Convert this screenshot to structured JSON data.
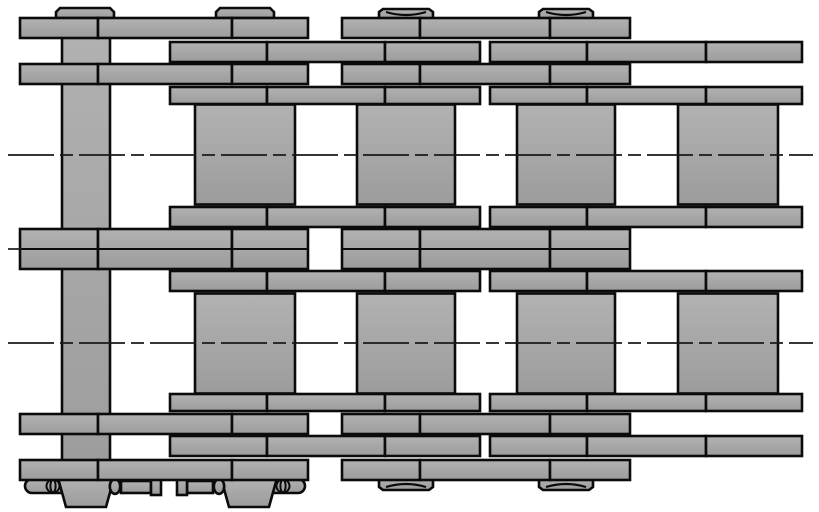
{
  "drawing": {
    "label": "Duplex roller chain plan-view engineering drawing with cottered connecting pins",
    "canvas": {
      "w": 819,
      "h": 512,
      "bg": "#ffffff"
    },
    "style": {
      "fill_top": "#b2b2b2",
      "fill_bottom": "#9c9c9c",
      "outline": "#0b0b0b",
      "outline_w": 2.6,
      "arc_w": 2.2,
      "centerline_color": "#1a1a1a",
      "centerline_w": 1.7,
      "centerline_dash": "46 6 13 6"
    },
    "segments": {
      "pin_phase": [
        [
          20,
          98
        ],
        [
          98,
          232
        ],
        [
          232,
          308
        ],
        [
          342,
          420
        ],
        [
          420,
          550
        ],
        [
          550,
          630
        ]
      ],
      "roller_phase": [
        [
          170,
          267
        ],
        [
          267,
          385
        ],
        [
          385,
          480
        ],
        [
          490,
          587
        ],
        [
          587,
          706
        ],
        [
          706,
          802
        ]
      ]
    },
    "plate_rows": [
      {
        "name": "plate-row-top-outer",
        "phase": "pin_phase",
        "y": 18,
        "h": 20
      },
      {
        "name": "plate-row-top-2",
        "phase": "roller_phase",
        "y": 42,
        "h": 20
      },
      {
        "name": "plate-row-top-3",
        "phase": "pin_phase",
        "y": 64,
        "h": 20
      },
      {
        "name": "plate-row-top-inner",
        "phase": "roller_phase",
        "y": 87,
        "h": 17
      },
      {
        "name": "plate-row-mid-upper",
        "phase": "roller_phase",
        "y": 207,
        "h": 20
      },
      {
        "name": "plate-row-mid-lower",
        "phase": "roller_phase",
        "y": 271,
        "h": 20
      },
      {
        "name": "plate-row-bottom-inner",
        "phase": "roller_phase",
        "y": 394,
        "h": 17
      },
      {
        "name": "plate-row-bottom-3",
        "phase": "pin_phase",
        "y": 414,
        "h": 20
      },
      {
        "name": "plate-row-bottom-2",
        "phase": "roller_phase",
        "y": 436,
        "h": 20
      },
      {
        "name": "plate-row-bottom-outer",
        "phase": "pin_phase",
        "y": 460,
        "h": 20
      }
    ],
    "center_band": {
      "phase": "pin_phase",
      "y": 229,
      "h": 40,
      "mid": 249
    },
    "roller_rows": [
      {
        "y": 104.5,
        "h": 100
      },
      {
        "y": 293.5,
        "h": 100
      }
    ],
    "rollers_x": [
      [
        195,
        295
      ],
      [
        357,
        455
      ],
      [
        517,
        615
      ],
      [
        678,
        778
      ]
    ],
    "pin_bar": {
      "x": 62,
      "y": 18,
      "w": 48,
      "h": 462
    },
    "caps": {
      "flat": {
        "y": 8,
        "h": 10,
        "half_w": 29,
        "chamfer": 4,
        "centers": [
          85,
          245
        ]
      },
      "dished_top": {
        "y": 9,
        "h": 11,
        "half_w": 27,
        "sag": 6,
        "centers": [
          406,
          566
        ]
      },
      "dished_bottom": {
        "y": 479,
        "h": 11,
        "half_w": 27,
        "sag": 6,
        "centers": [
          406,
          566
        ]
      }
    },
    "cotters": {
      "left": {
        "head_pill": {
          "x": 25,
          "y": 479,
          "w": 37,
          "h": 14,
          "round": "left"
        },
        "eye_rings": {
          "cx": 53,
          "cy": 486,
          "rx_outer": 6.5,
          "rx_inner": 2.6,
          "ry": 6.4
        },
        "taper": {
          "cx": 86,
          "y": 478,
          "top_half_w": 28,
          "bot_half_w": 20,
          "h": 29
        },
        "exit_ring": {
          "cx": 115,
          "cy": 486.5,
          "rx": 5.2,
          "ry": 7.4
        },
        "prong_bar": {
          "x": 121,
          "y": 481,
          "w": 30,
          "h": 12
        },
        "prong_tip": {
          "x": 151,
          "y": 478,
          "w": 10,
          "h": 17
        }
      },
      "right": {
        "prong_tip": {
          "x": 177,
          "y": 478,
          "w": 10,
          "h": 17
        },
        "prong_bar": {
          "x": 187,
          "y": 481,
          "w": 26,
          "h": 12
        },
        "exit_ring": {
          "cx": 219,
          "cy": 486.5,
          "rx": 5.2,
          "ry": 7.4
        },
        "taper": {
          "cx": 249,
          "y": 478,
          "top_half_w": 28,
          "bot_half_w": 20,
          "h": 29
        },
        "eye_rings": {
          "cx": 283,
          "cy": 486,
          "rx_outer": 6.5,
          "rx_inner": 2.6,
          "ry": 6.4
        },
        "head_pill": {
          "x": 271,
          "y": 479,
          "w": 34,
          "h": 14,
          "round": "right"
        }
      }
    },
    "centerlines": [
      {
        "name": "upper-strand-centerline",
        "y": 155,
        "x1": 8,
        "x2": 813,
        "dashed": true
      },
      {
        "name": "lower-strand-centerline",
        "y": 343,
        "x1": 8,
        "x2": 813,
        "dashed": true
      },
      {
        "name": "middle-centerline-stub-left",
        "y": 249,
        "x1": 8,
        "x2": 22,
        "dashed": false
      }
    ]
  }
}
